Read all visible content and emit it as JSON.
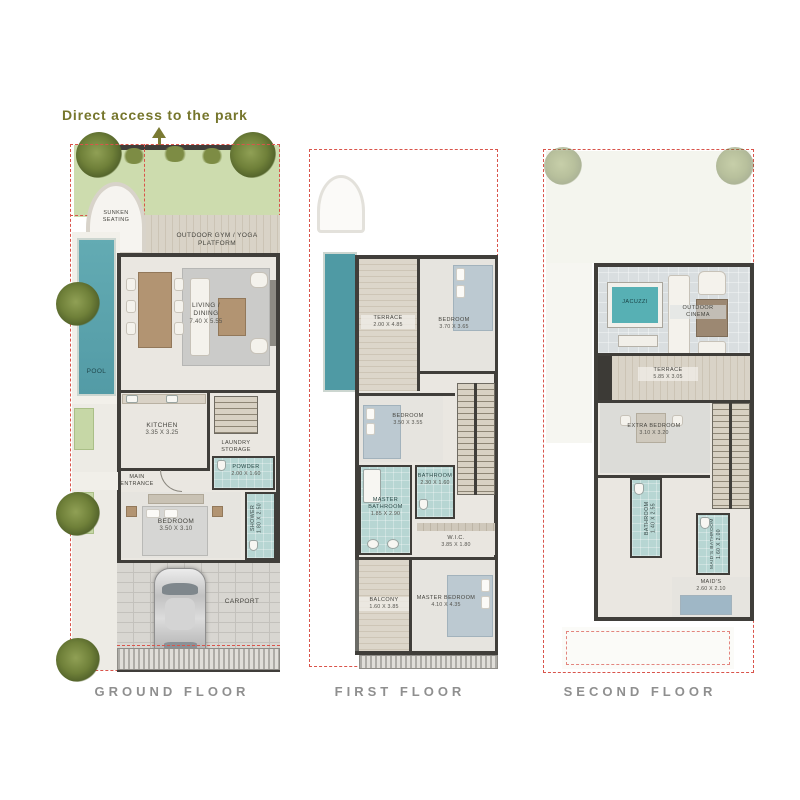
{
  "annotation": {
    "park_access_label": "Direct access to the park"
  },
  "colors": {
    "setback_dashed_red": "#d9544b",
    "olive_text": "#76762c",
    "pool_teal": "#5aa3ad",
    "wet_room_teal": "#b7d6d3",
    "title_gray": "#8f8f8f"
  },
  "floors": [
    {
      "title": "GROUND FLOOR",
      "rooms": [
        {
          "l1": "SUNKEN SEATING",
          "l2": ""
        },
        {
          "l1": "OUTDOOR GYM / YOGA PLATFORM",
          "l2": ""
        },
        {
          "l1": "POOL",
          "l2": ""
        },
        {
          "l1": "LIVING / DINING",
          "l2": "7.40 X 5.55"
        },
        {
          "l1": "KITCHEN",
          "l2": "3.35 X 3.25"
        },
        {
          "l1": "LAUNDRY STORAGE",
          "l2": ""
        },
        {
          "l1": "MAIN ENTRANCE",
          "l2": ""
        },
        {
          "l1": "POWDER",
          "l2": "2.00 X 1.60"
        },
        {
          "l1": "BEDROOM",
          "l2": "3.50 X 3.10"
        },
        {
          "l1": "SHOWER",
          "l2": "1.80 X 2.50"
        },
        {
          "l1": "CARPORT",
          "l2": ""
        }
      ]
    },
    {
      "title": "FIRST FLOOR",
      "rooms": [
        {
          "l1": "TERRACE",
          "l2": "2.00 X 4.85"
        },
        {
          "l1": "BEDROOM",
          "l2": "3.70 X 3.65"
        },
        {
          "l1": "BEDROOM",
          "l2": "3.50 X 3.55"
        },
        {
          "l1": "BATHROOM",
          "l2": "2.30 X 1.60"
        },
        {
          "l1": "MASTER BATHROOM",
          "l2": "1.85 X 2.90"
        },
        {
          "l1": "W.I.C.",
          "l2": "3.85 X 1.80"
        },
        {
          "l1": "BALCONY",
          "l2": "1.60 X 3.85"
        },
        {
          "l1": "MASTER BEDROOM",
          "l2": "4.10 X 4.35"
        }
      ]
    },
    {
      "title": "SECOND FLOOR",
      "rooms": [
        {
          "l1": "JACUZZI",
          "l2": ""
        },
        {
          "l1": "OUTDOOR CINEMA",
          "l2": ""
        },
        {
          "l1": "TERRACE",
          "l2": "5.85 X 3.05"
        },
        {
          "l1": "EXTRA BEDROOM",
          "l2": "3.10 X 3.20"
        },
        {
          "l1": "BATHROOM",
          "l2": "1.40 X 2.55"
        },
        {
          "l1": "MAID'S BATHROOM",
          "l2": "1.60 X 2.00"
        },
        {
          "l1": "MAID'S",
          "l2": "2.60 X 2.10"
        }
      ]
    }
  ]
}
